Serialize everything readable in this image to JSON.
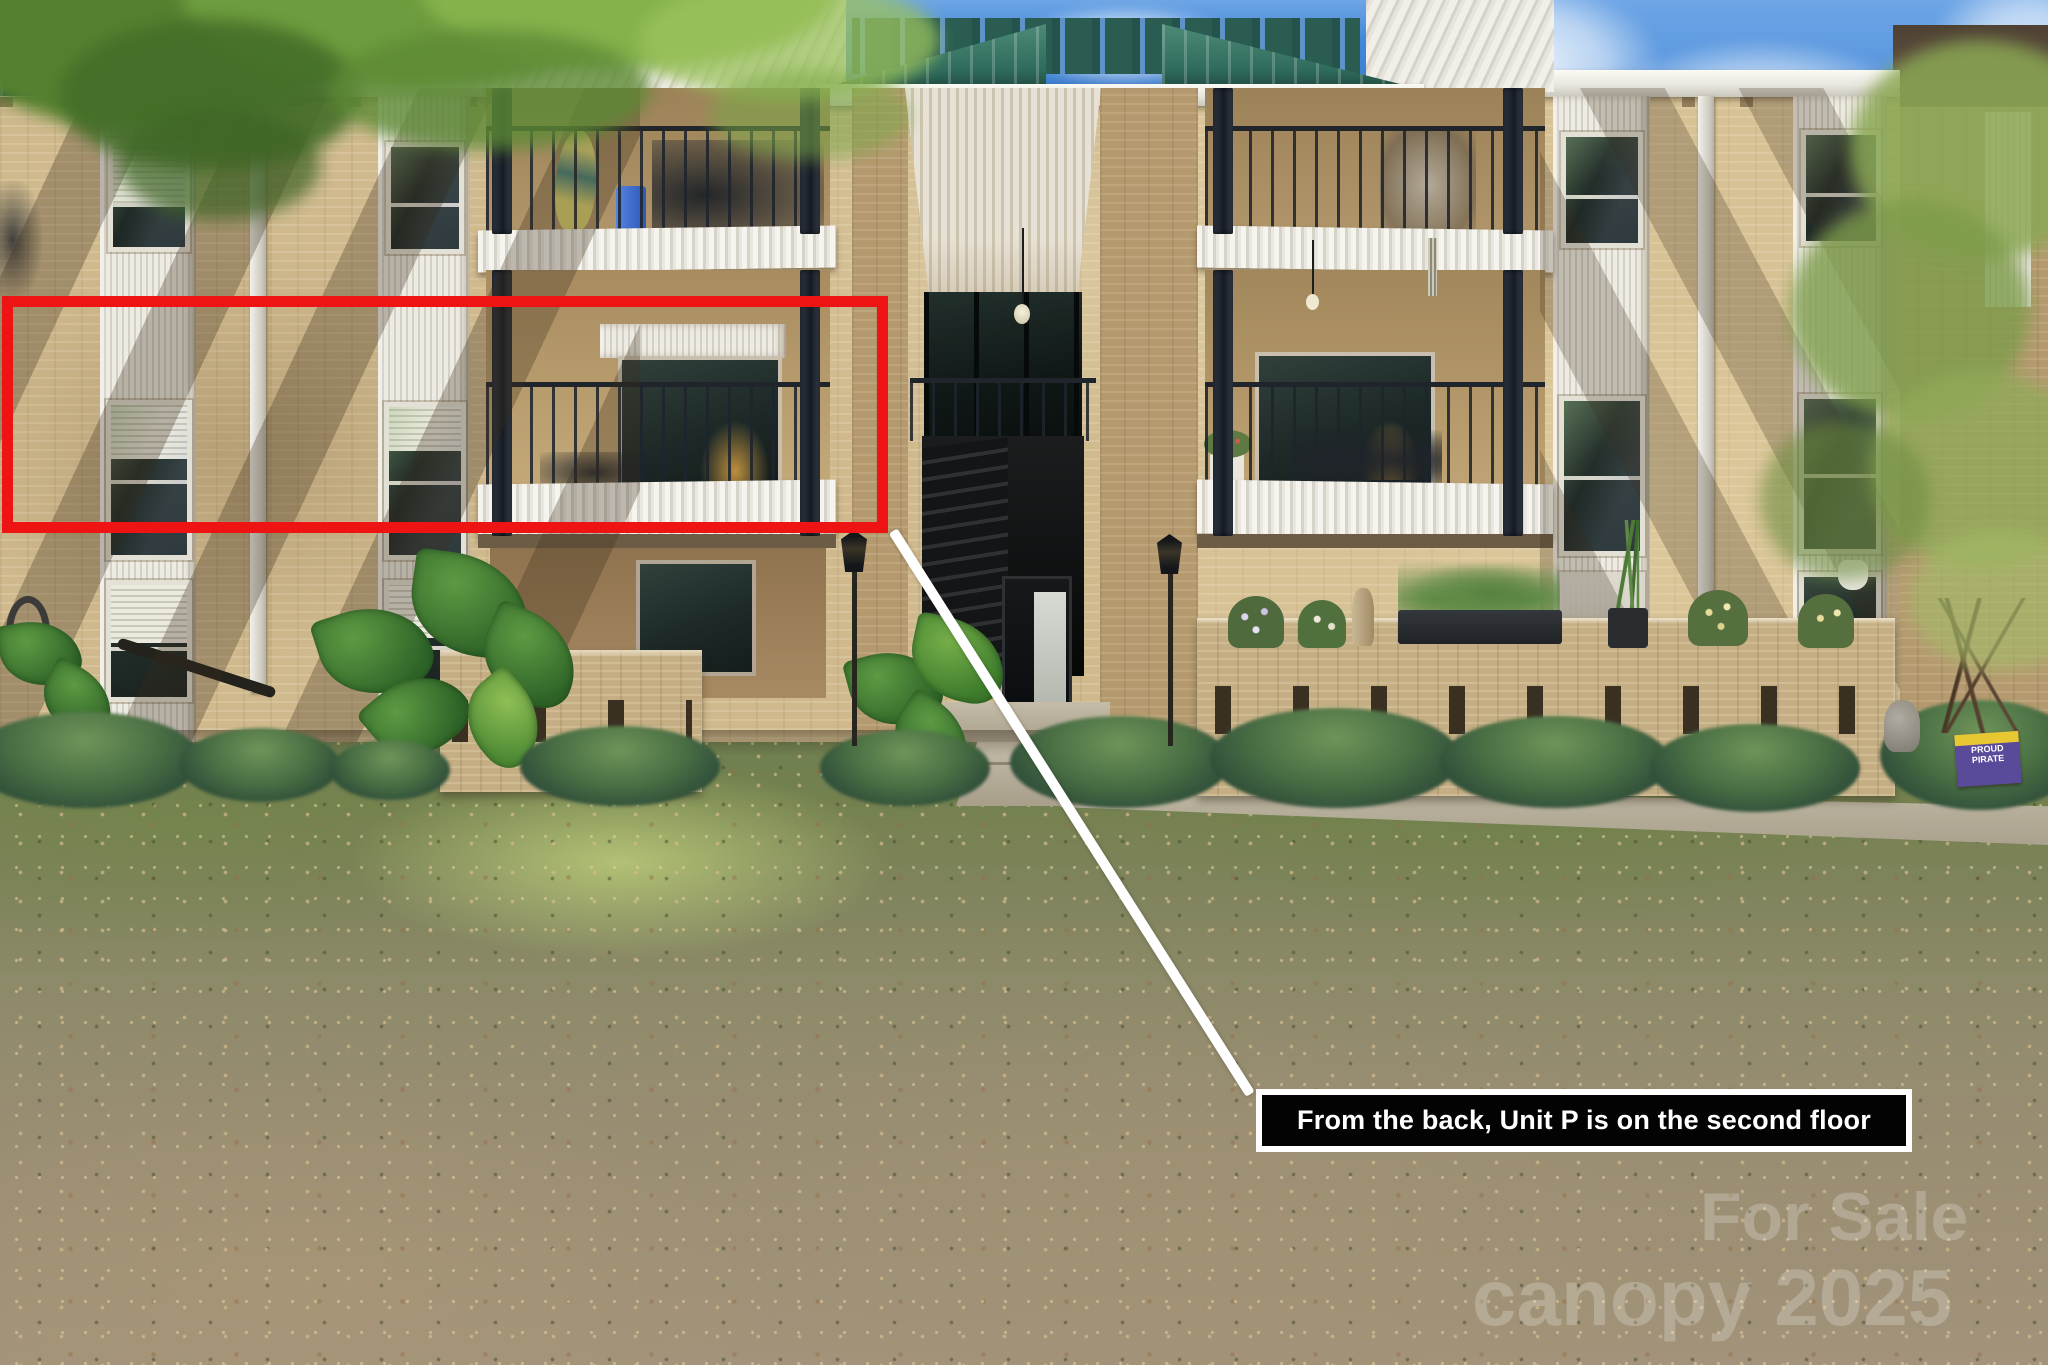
{
  "scene": {
    "kind": "annotated real-estate photograph",
    "subject": "Rear exterior of a three-story tan brick condo building with stacked balconies, a center breezeway entrance with black stairs, landscaped planters, and a large patchy lawn",
    "annotations": {
      "highlight_box_color": "#ee1414",
      "callout_line_color": "#ffffff",
      "label": {
        "text": "From the back, Unit P is on the second floor",
        "background": "#030303",
        "border_color": "#ffffff",
        "text_color": "#ffffff"
      }
    },
    "watermark": {
      "line1": "For Sale",
      "line2": "canopy 2025",
      "color": "#ffffff",
      "opacity": 0.22
    },
    "yard_sign": {
      "line1": "PROUD",
      "line2": "PIRATE",
      "background": "#5a4a9a",
      "accent": "#e8c832"
    }
  }
}
